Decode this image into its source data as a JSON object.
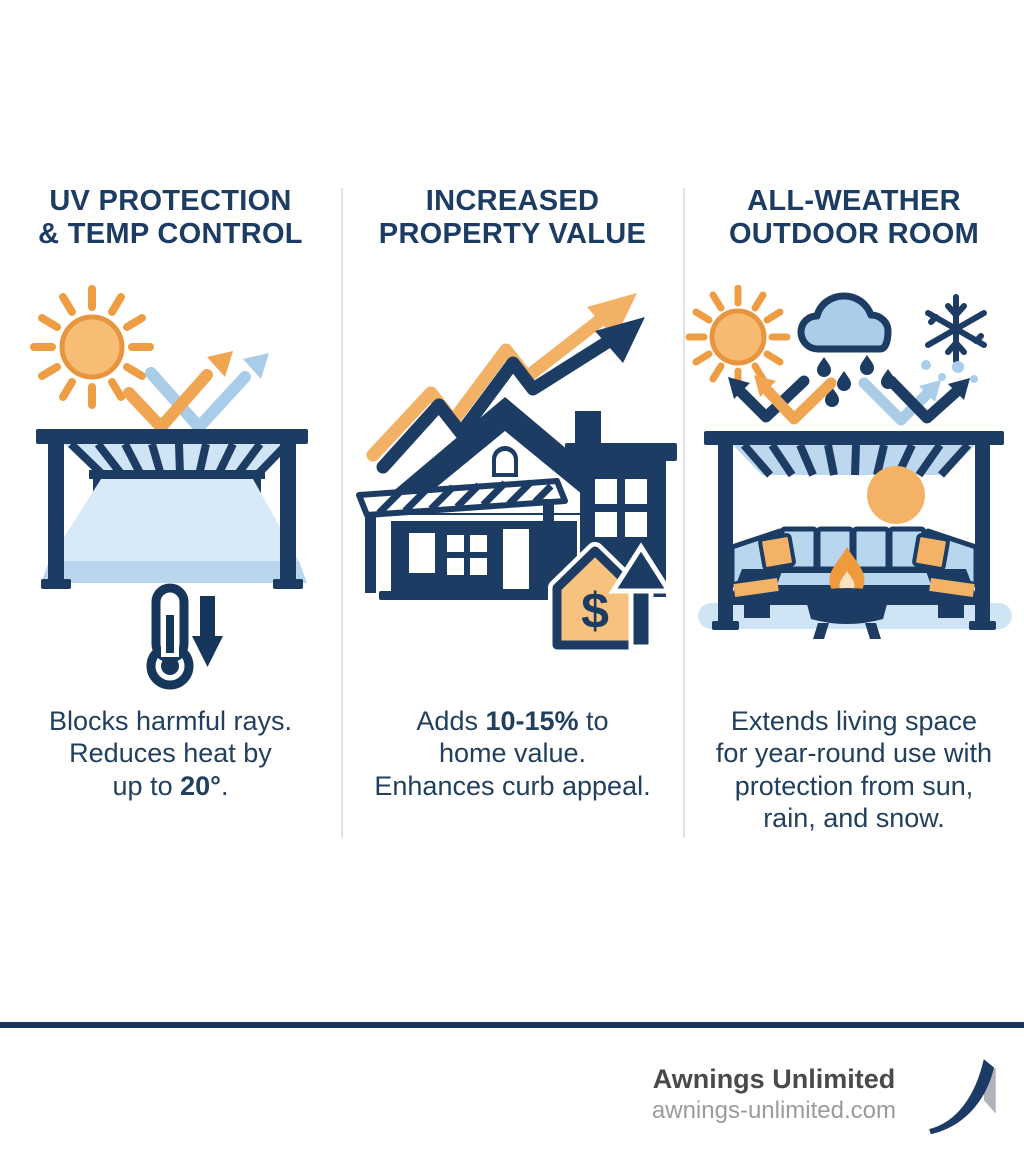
{
  "page": {
    "background": "#ffffff"
  },
  "colors": {
    "navy": "#1d3c63",
    "orange": "#f0a552",
    "light_orange_fill": "#f6bd74",
    "light_blue": "#a9cce9",
    "pale_blue": "#cfe4f5",
    "divider": "#dbe5ec",
    "footer_rule": "#15355e",
    "company_text": "#4a4a4a",
    "website_text": "#9b9b9b"
  },
  "columns": [
    {
      "id": "uv-protection",
      "title_lines": [
        "UV PROTECTION",
        "& TEMP CONTROL"
      ],
      "caption_lines": [
        [
          {
            "t": "Blocks harmful rays.",
            "b": false
          }
        ],
        [
          {
            "t": "Reduces heat by",
            "b": false
          }
        ],
        [
          {
            "t": "up to ",
            "b": false
          },
          {
            "t": "20°",
            "b": true
          },
          {
            "t": ".",
            "b": false
          }
        ]
      ],
      "icons": [
        "sun-icon",
        "reflection-arrows-icon",
        "pergola-icon",
        "thermometer-icon",
        "down-arrow-icon"
      ]
    },
    {
      "id": "property-value",
      "title_lines": [
        "INCREASED",
        "PROPERTY VALUE"
      ],
      "caption_lines": [
        [
          {
            "t": "Adds ",
            "b": false
          },
          {
            "t": "10-15%",
            "b": true
          },
          {
            "t": " to",
            "b": false
          }
        ],
        [
          {
            "t": "home value.",
            "b": false
          }
        ],
        [
          {
            "t": "Enhances curb appeal.",
            "b": false
          }
        ]
      ],
      "badge": "$",
      "icons": [
        "growth-arrow-icon",
        "house-icon",
        "dollar-house-icon",
        "up-arrow-icon"
      ]
    },
    {
      "id": "all-weather",
      "title_lines": [
        "ALL-WEATHER",
        "OUTDOOR ROOM"
      ],
      "caption_lines": [
        [
          {
            "t": "Extends living space",
            "b": false
          }
        ],
        [
          {
            "t": "for year-round use with",
            "b": false
          }
        ],
        [
          {
            "t": "protection from sun,",
            "b": false
          }
        ],
        [
          {
            "t": "rain, and snow.",
            "b": false
          }
        ]
      ],
      "icons": [
        "sun-icon",
        "rain-cloud-icon",
        "snowflake-icon",
        "bounce-arrows-icon",
        "pergola-lounge-icon",
        "fire-pit-icon"
      ]
    }
  ],
  "footer": {
    "company": "Awnings Unlimited",
    "website": "awnings-unlimited.com"
  }
}
